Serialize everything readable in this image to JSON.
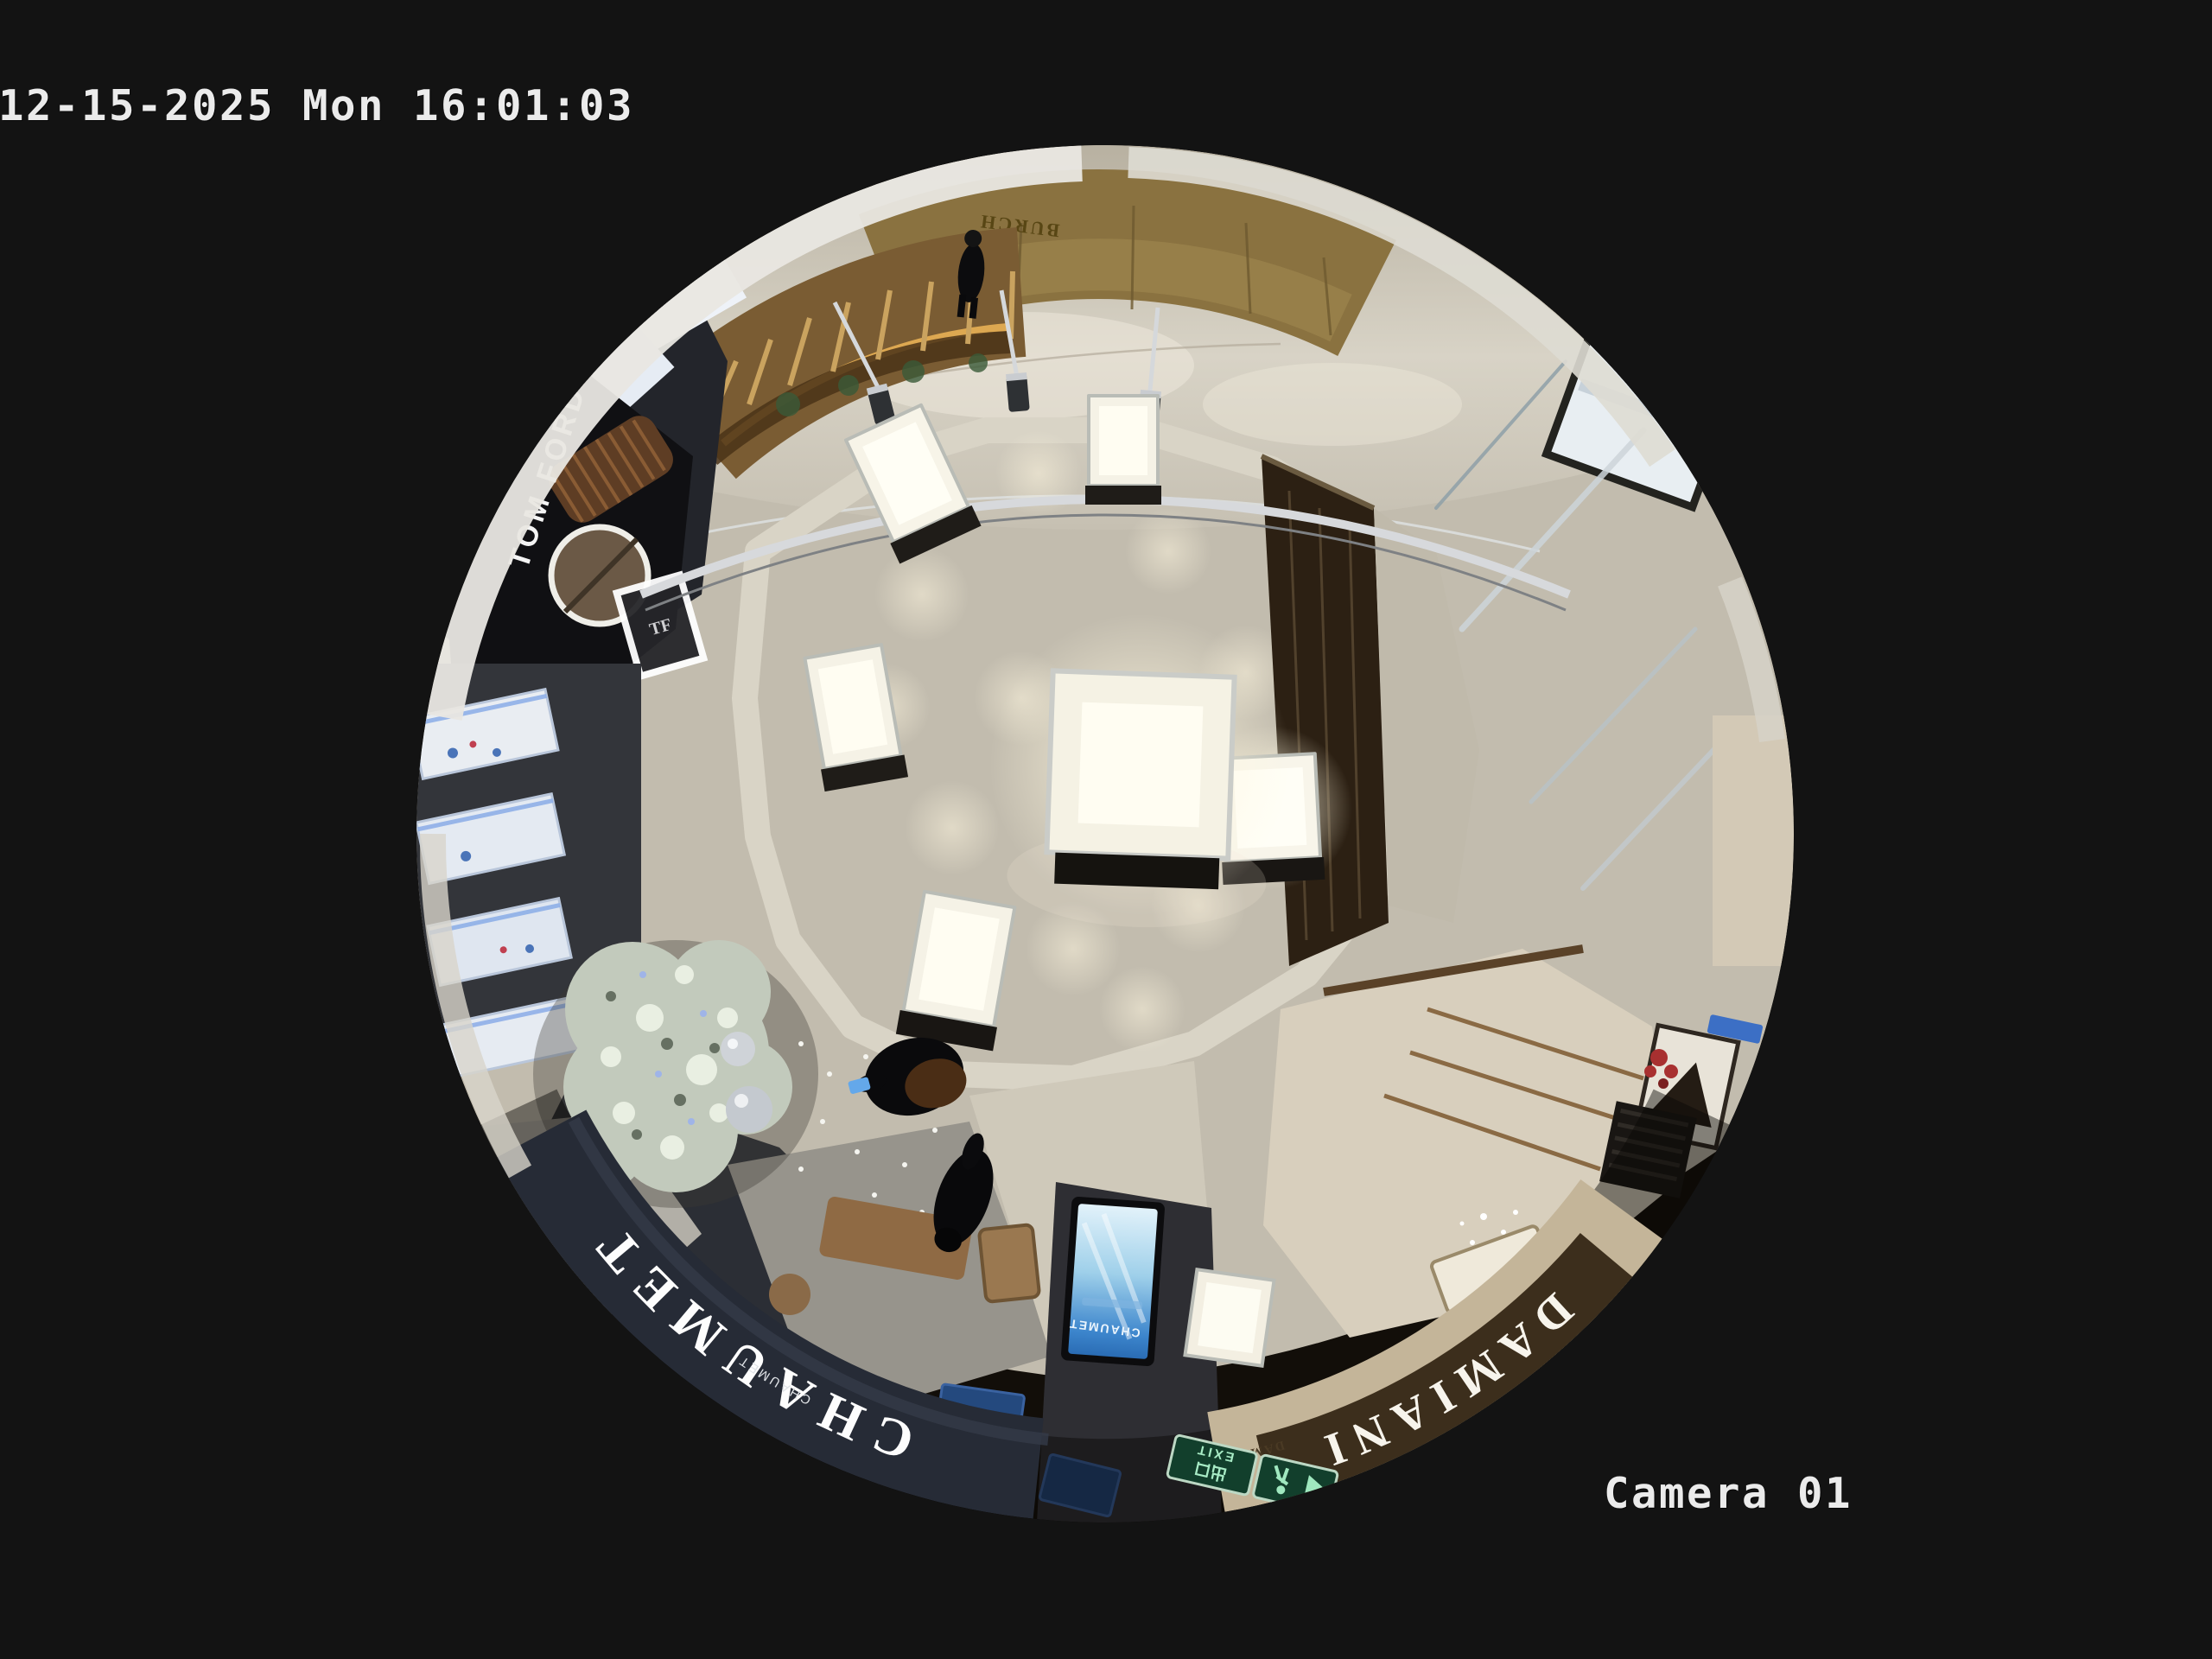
{
  "osd": {
    "timestamp": "12-15-2025 Mon 16:01:03",
    "camera_label": "Camera 01"
  },
  "signs": {
    "tom_ford": "TOM FORD",
    "tom_ford_monogram": "TF",
    "gold_wall": "BURCH",
    "chaumet": "CHAUMET",
    "chaumet_small": "CHAUMET",
    "chaumet_screen": "CHAUMET",
    "damiani": "DAMIANI",
    "damiani_small": "DAMIANI",
    "exit": "EXIT",
    "exit_cn": "出口"
  },
  "colors": {
    "background": "#131313",
    "osd_text": "#ebebeb",
    "wood_floor": "#46311f",
    "stone_walkway": "#c2bcae",
    "gold_wall": "#8a7240",
    "chaumet_fascia": "#262b36",
    "damiani_fascia": "#3c2e1c",
    "screen_blue": "#3c85cc",
    "exit_green": "#123f2c"
  }
}
